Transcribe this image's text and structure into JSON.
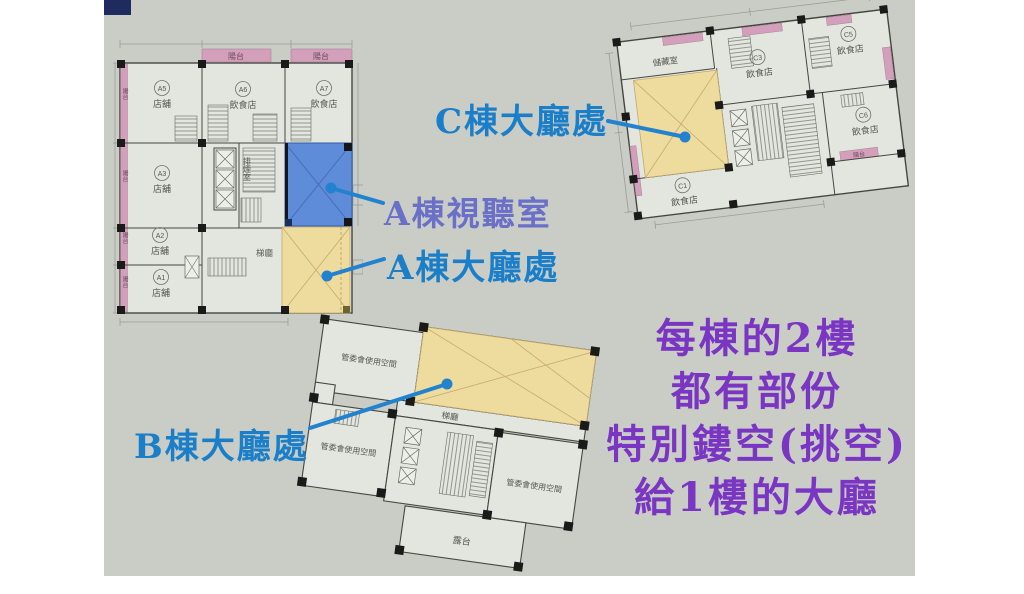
{
  "colors": {
    "slide_bg": "#c9cdc6",
    "accent_navy": "#1f2a5e",
    "plan_paper": "#e3e5df",
    "highlight_yellow": "#eedc9e",
    "highlight_blue": "#5f8cd8",
    "balcony_pink": "#d49fbb",
    "callout_blue": "#2382cf",
    "label_blue": "#1a7ec9",
    "label_violet": "#6a6fc8",
    "note_purple": "#7b35c3"
  },
  "plan_a": {
    "balcony_label": "陽台",
    "units": {
      "a1": {
        "id": "A1",
        "type": "店舖"
      },
      "a2": {
        "id": "A2",
        "type": "店舖"
      },
      "a3": {
        "id": "A3",
        "type": "店舖"
      },
      "a5": {
        "id": "A5",
        "type": "店舖"
      },
      "a6": {
        "id": "A6",
        "type": "飲食店"
      },
      "a7": {
        "id": "A7",
        "type": "飲食店"
      }
    },
    "rooms": {
      "smoke_exhaust": "排煙室",
      "stair_hall": "梯廳"
    }
  },
  "plan_b": {
    "room_mgmt": "管委會使用空間",
    "stair_hall": "梯廳",
    "terrace": "露台"
  },
  "plan_c": {
    "balcony_label": "陽台",
    "storage": "儲藏室",
    "units": {
      "c1": {
        "id": "C1",
        "type": "飲食店"
      },
      "c3": {
        "id": "C3",
        "type": "飲食店"
      },
      "c5": {
        "id": "C5",
        "type": "飲食店"
      },
      "c6": {
        "id": "C6",
        "type": "飲食店"
      }
    }
  },
  "callouts": {
    "c_lobby": "C棟大廳處",
    "a_av_room": "A棟視聽室",
    "a_lobby": "A棟大廳處",
    "b_lobby": "B棟大廳處"
  },
  "note": {
    "line1": "每棟的2樓",
    "line2": "都有部份",
    "line3": "特別鏤空(挑空)",
    "line4": "給1樓的大廳"
  }
}
